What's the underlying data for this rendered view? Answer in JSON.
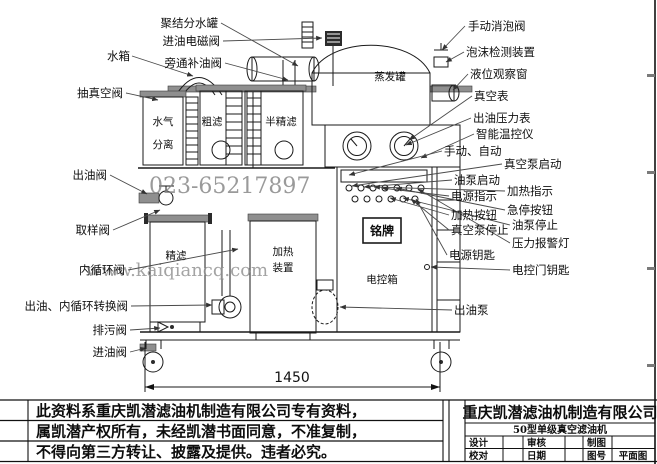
{
  "colors": {
    "line": "#1a1a1a",
    "pipe_gray": "#8f8f8f",
    "watermark_gray": "#828282",
    "background": "#ffffff"
  },
  "watermarks": {
    "phone": "023-65217897",
    "website": "www.kaiqiancq.com"
  },
  "diagram": {
    "dimension_width": "1450",
    "labels": {
      "coalescer_tank": "聚结分水罐",
      "inlet_solenoid_valve": "进油电磁阀",
      "bypass_refill_valve": "旁通补油阀",
      "water_tank": "水箱",
      "vacuum_suction_valve": "抽真空阀",
      "oil_outlet_valve": "出油阀",
      "sampling_valve": "取样阀",
      "inner_circulation_valve": "内循环阀",
      "outlet_circulation_switch_valve": "出油、内循环转换阀",
      "drain_valve": "排污阀",
      "oil_inlet_valve": "进油阀",
      "manual_defoam_valve": "手动消泡阀",
      "foam_detector": "泡沫检测装置",
      "level_sight_glass": "液位观察窗",
      "vacuum_gauge": "真空表",
      "outlet_pressure_gauge": "出油压力表",
      "smart_temp_controller": "智能温控仪",
      "manual_auto": "手动、自动",
      "vacuum_pump_start": "真空泵启动",
      "oil_pump_start": "油泵启动",
      "heating_indicator": "加热指示",
      "power_indicator": "电源指示",
      "heating_button": "加热按钮",
      "emergency_stop_button": "急停按钮",
      "oil_pump_stop": "油泵停止",
      "vacuum_pump_stop": "真空泵停止",
      "pressure_alarm_lamp": "压力报警灯",
      "power_key": "电源钥匙",
      "cabinet_door_key": "电控门钥匙",
      "oil_outlet_pump": "出油泵"
    },
    "parts": {
      "evaporation_tank": "蒸发罐",
      "water_gas_separator_l1": "水气",
      "water_gas_separator_l2": "分离",
      "coarse_filter": "粗滤",
      "semi_fine_filter": "半精滤",
      "fine_filter": "精滤",
      "heater_l1": "加热",
      "heater_l2": "装置",
      "control_box": "电控箱",
      "nameplate": "铭牌"
    }
  },
  "notice": {
    "line1": "此资料系重庆凯潜滤油机制造有限公司专有资料，",
    "line2": "属凯潜产权所有，未经凯潜书面同意，不准复制，",
    "line3": "不得向第三方转让、披露及提供。违者必究。"
  },
  "title_block": {
    "company": "重庆凯潜滤油机制造有限公司",
    "product": "50型单级真空滤油机",
    "design": "设计",
    "review": "审核",
    "draft": "制图",
    "proofread": "校对",
    "date": "日期",
    "drawing_no": "图号",
    "view_name": "平面图"
  }
}
